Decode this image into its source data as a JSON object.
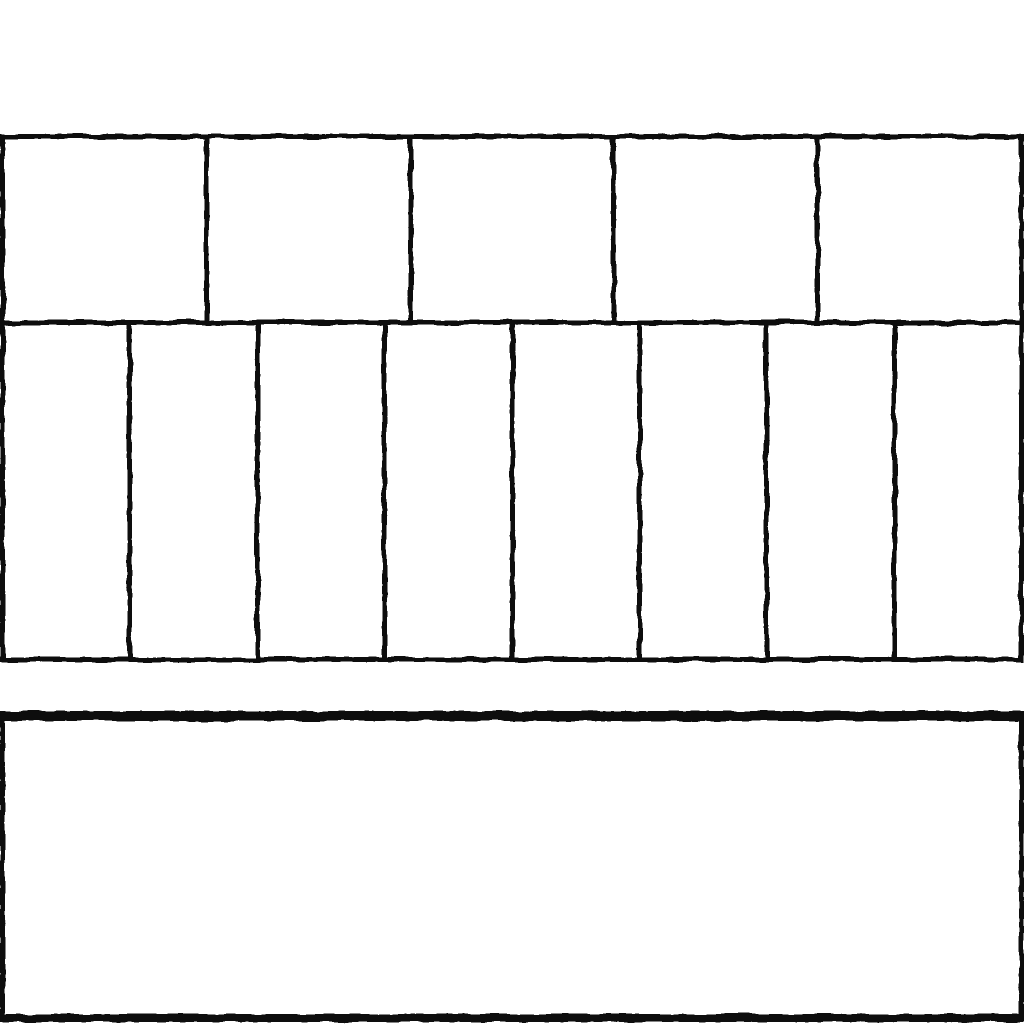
{
  "canvas": {
    "background_color": "#ffffff",
    "stroke_color": "#0d0d0d"
  },
  "wireframe": {
    "grid_rows": [
      {
        "name": "top-row",
        "cells": 5
      },
      {
        "name": "middle-row",
        "cells": 8
      }
    ],
    "bottom_panel": {
      "cells": 1
    }
  }
}
